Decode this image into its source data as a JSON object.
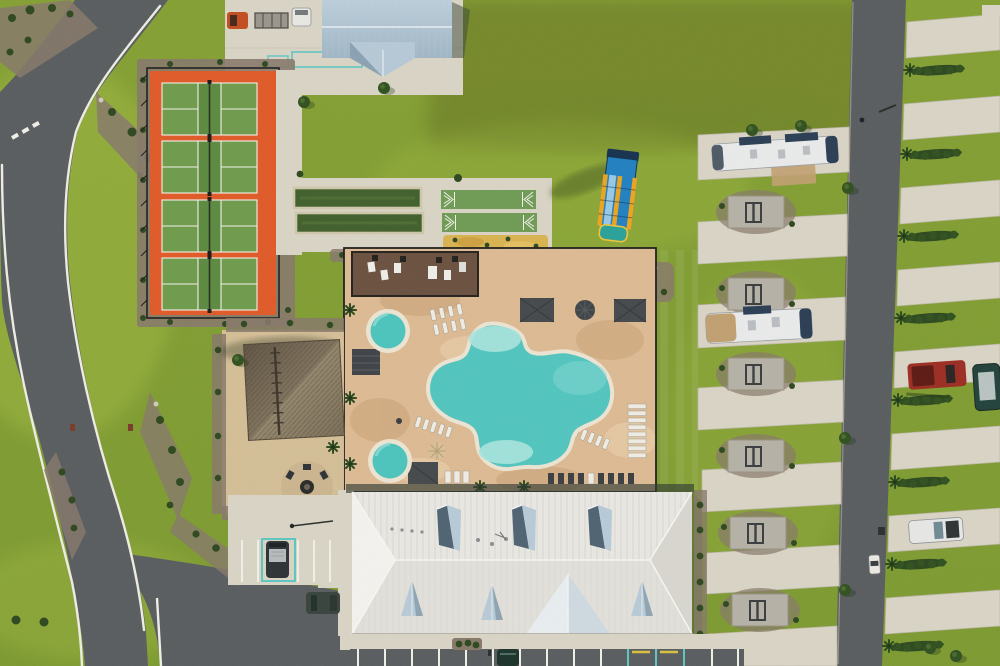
{
  "meta": {
    "type": "aerial-drone-photo",
    "subject": "RV resort amenity complex with pickleball courts, pool, clubhouse and RV sites",
    "width_px": 1000,
    "height_px": 666
  },
  "scene": {
    "facilities": [
      "pickleball-courts",
      "bocce-courts",
      "shuffleboard-courts",
      "sand-play-bed",
      "inflatable-water-slide",
      "outdoor-kitchen-patio",
      "cabanas",
      "free-form-pool",
      "two-spas",
      "tiki-hut",
      "fire-pit-lounge",
      "clubhouse",
      "maintenance-building",
      "rv-pad-rows",
      "parking-lot",
      "resort-roads",
      "landscape-beds"
    ],
    "counts": {
      "pickleball_courts": 4,
      "bocce_courts": 2,
      "shuffleboard_courts": 2,
      "spas": 2,
      "cabanas": 3,
      "center_rv_pads": 7,
      "east_rv_pads": 8,
      "rv_patio_squares": 6
    },
    "vehicles": [
      "travel-trailer-white-navy",
      "travel-trailer-white-tan",
      "orange-pickup",
      "utility-trailer",
      "white-van",
      "red-truck",
      "dark-teal-rv",
      "white-pickup",
      "golf-cart",
      "dark-van",
      "dark-suv",
      "green-car"
    ]
  },
  "colors": {
    "grass": "#86a134",
    "grass_dark": "#6e872b",
    "grass_bright": "#9db53f",
    "grass_olive": "#74862c",
    "asphalt": "#595d5f",
    "road_line": "#eeece3",
    "concrete": "#d9d4c5",
    "concrete_edge": "#bdb7a6",
    "patio_concrete": "#b5b1a6",
    "paver_deck": "#dcba93",
    "paver_dark": "#c89f74",
    "paver_light": "#ecd5b2",
    "mulch": "#87796a",
    "shrub": "#2e481f",
    "tree_green": "#31511f",
    "court_orange": "#e05a28",
    "court_green": "#6f9b4c",
    "court_green_dark": "#5c8a40",
    "court_line": "#f2f1ea",
    "fence_dark": "#1f1f1f",
    "bocce_green": "#41602c",
    "bocce_frame": "#cfc6a9",
    "shuffle_green": "#6f9b55",
    "sand": "#d9b350",
    "pool_water": "#52c5be",
    "pool_shallow": "#a9e3dd",
    "pool_mid": "#7fd6cf",
    "pool_coping": "#ece4d2",
    "spa_water": "#4cc4bc",
    "thatch": "#8a7c64",
    "thatch_dark": "#5f5443",
    "thatch_light": "#a3967d",
    "cabana_gray": "#45494c",
    "pergola_dark": "#3f4347",
    "roof_white": "#e9e7e2",
    "roof_seam": "#c8c6bf",
    "roof_gable_blue": "#b7cad7",
    "roof_shadow_slate": "#4f6372",
    "mnt_roof_light": "#b6c9d6",
    "mnt_roof_dark": "#9db4c4",
    "slide_blue": "#2280c0",
    "slide_navy": "#16324f",
    "slide_yellow": "#eda41d",
    "slide_teal": "#2aa198",
    "rv_white": "#e9eaea",
    "rv_navy": "#2b3e54",
    "rv_tan": "#c1a071",
    "truck_orange": "#c24e20",
    "truck_red": "#9c2d23",
    "rv_dark_teal": "#23423c",
    "cart_white": "#eceae2",
    "van_dark": "#2e3335",
    "suv_dark": "#39433d",
    "car_green": "#1c342b",
    "handicap_teal": "#5ec6c1",
    "paint_yellow": "#d9c040",
    "sign_red": "#7a3b2a",
    "boulder": "#cfc9bb",
    "person_dark": "#2b2e30",
    "shadow_green": "#3a4a1d"
  }
}
